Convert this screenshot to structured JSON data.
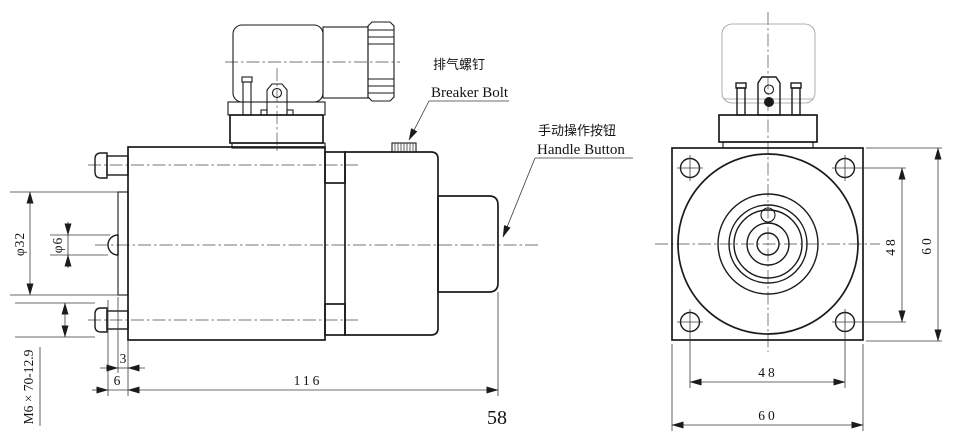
{
  "left": {
    "callouts": {
      "breaker_cn": "排气螺钉",
      "breaker_en": "Breaker Bolt",
      "handle_cn": "手动操作按钮",
      "handle_en": "Handle Button"
    },
    "dims": {
      "phi32": "φ32",
      "phi6": "φ6",
      "bolt_spec": "M6 × 70-12.9",
      "d3": "3",
      "d6": "6",
      "d116": "116",
      "d58": "58"
    }
  },
  "right": {
    "dims": {
      "v48": "48",
      "v60": "60",
      "h48": "48",
      "h60": "60"
    }
  },
  "colors": {
    "line": "#1b1b1b",
    "thin_line": "#3a3a3a",
    "background": "#ffffff"
  }
}
